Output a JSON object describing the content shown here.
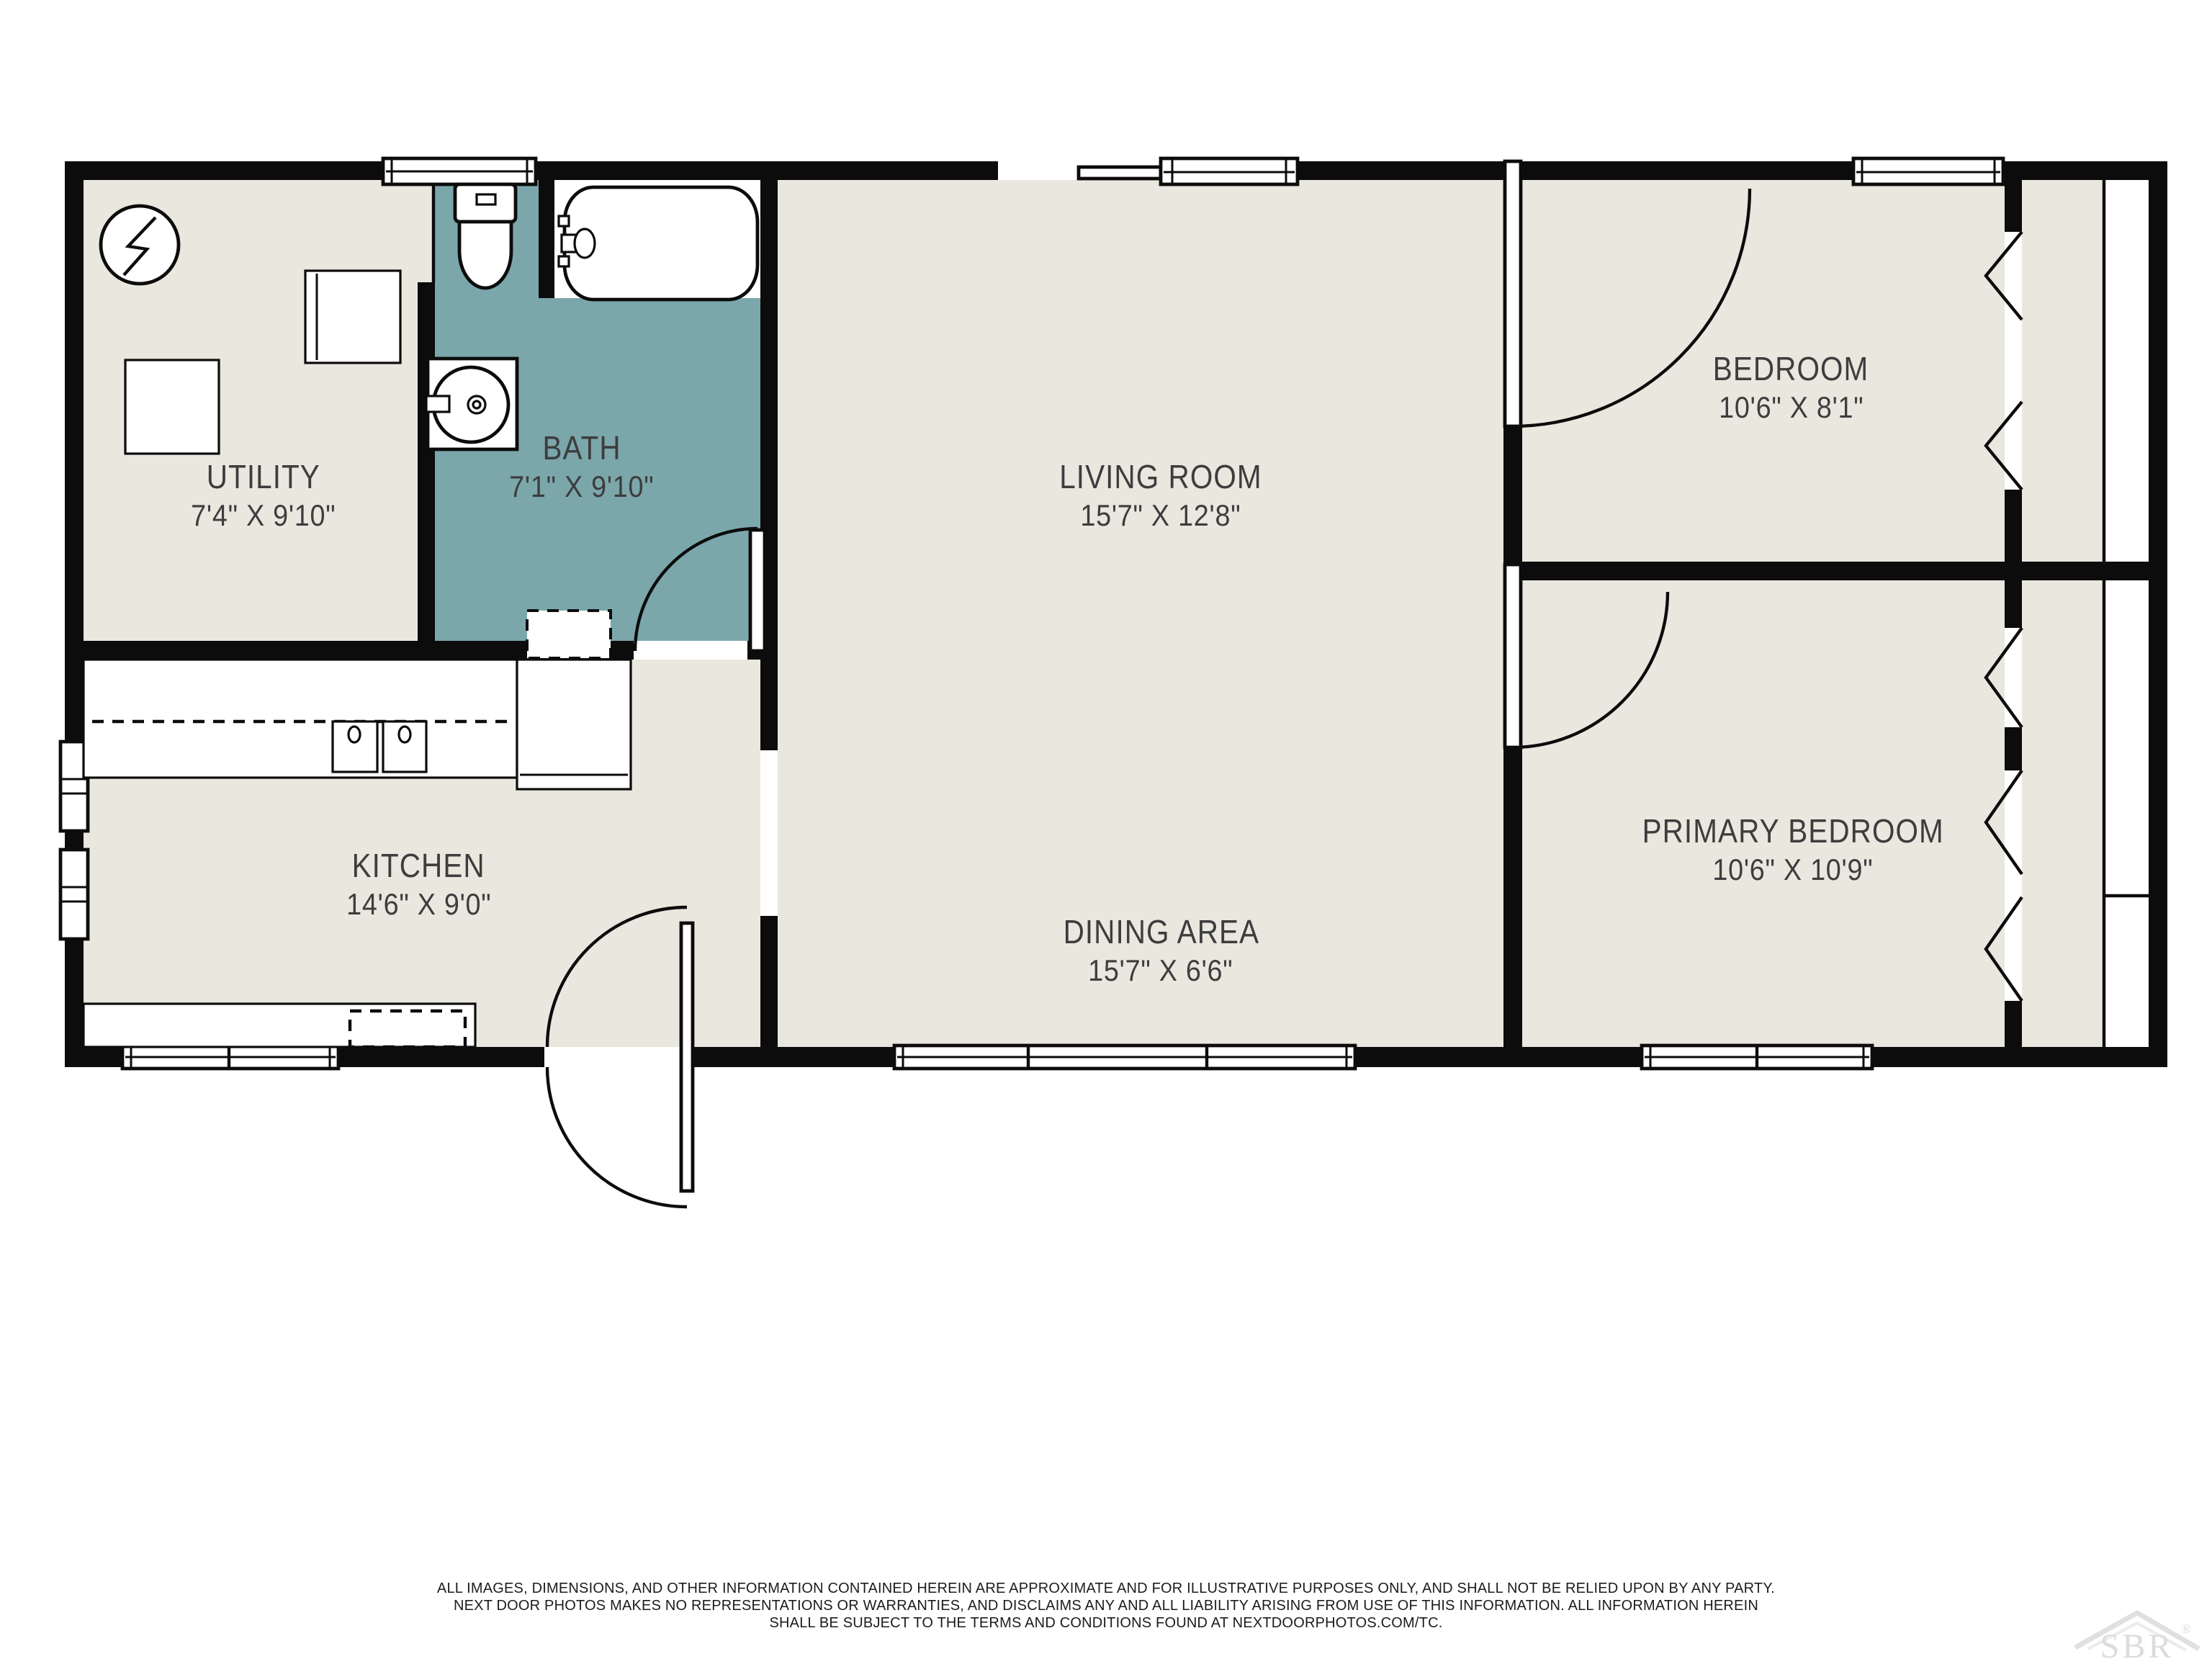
{
  "page": {
    "background": "#ffffff"
  },
  "plan": {
    "colors": {
      "wall": "#0c0c0c",
      "floor": "#e9e7de",
      "bathfloor": "#7ba7ab",
      "label": "#3d3d3d",
      "watermark": "#dcdcdc"
    },
    "rooms": [
      {
        "id": "utility",
        "name": "UTILITY",
        "dims": "7'4\" X 9'10\""
      },
      {
        "id": "bath",
        "name": "BATH",
        "dims": "7'1\" X 9'10\""
      },
      {
        "id": "living-room",
        "name": "LIVING ROOM",
        "dims": "15'7\" X 12'8\""
      },
      {
        "id": "bedroom",
        "name": "BEDROOM",
        "dims": "10'6\" X 8'1\""
      },
      {
        "id": "kitchen",
        "name": "KITCHEN",
        "dims": "14'6\" X 9'0\""
      },
      {
        "id": "dining-area",
        "name": "DINING AREA",
        "dims": "15'7\" X 6'6\""
      },
      {
        "id": "primary-bedroom",
        "name": "PRIMARY BEDROOM",
        "dims": "10'6\" X 10'9\""
      }
    ]
  },
  "footer": {
    "line1": "ALL IMAGES, DIMENSIONS, AND OTHER INFORMATION CONTAINED HEREIN ARE APPROXIMATE AND FOR ILLUSTRATIVE PURPOSES ONLY, AND SHALL NOT BE RELIED UPON BY ANY PARTY.",
    "line2": "NEXT DOOR PHOTOS MAKES NO REPRESENTATIONS OR WARRANTIES, AND DISCLAIMS ANY AND ALL LIABILITY ARISING FROM USE OF THIS INFORMATION. ALL INFORMATION HEREIN",
    "line3": "SHALL BE SUBJECT TO THE TERMS AND CONDITIONS FOUND AT NEXTDOORPHOTOS.COM/TC."
  },
  "watermark": {
    "text": "SBR",
    "registered": "®"
  }
}
